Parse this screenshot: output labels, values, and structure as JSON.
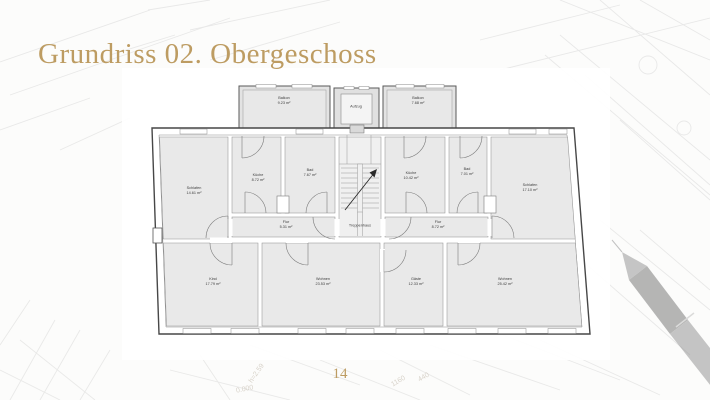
{
  "slide": {
    "title": "Grundriss 02. Obergeschoss",
    "page_number": "14"
  },
  "floorplan": {
    "rooms": [
      {
        "label": "Balkon",
        "area": "9.23 m²"
      },
      {
        "label": "Aufzug",
        "area": ""
      },
      {
        "label": "Balkon",
        "area": "7.68 m²"
      },
      {
        "label": "Schlafen",
        "area": "14.61 m²"
      },
      {
        "label": "Küche",
        "area": "8.72 m²"
      },
      {
        "label": "Bad",
        "area": "7.67 m²"
      },
      {
        "label": "Küche",
        "area": "10.42 m²"
      },
      {
        "label": "Bad",
        "area": "7.01 m²"
      },
      {
        "label": "Schlafen",
        "area": "17.10 m²"
      },
      {
        "label": "Flur",
        "area": "5.31 m²"
      },
      {
        "label": "Treppenhaus",
        "area": ""
      },
      {
        "label": "Flur",
        "area": "8.72 m²"
      },
      {
        "label": "Kind",
        "area": "17.79 m²"
      },
      {
        "label": "Wohnen",
        "area": "23.53 m²"
      },
      {
        "label": "Gäste",
        "area": "12.33 m²"
      },
      {
        "label": "Wohnen",
        "area": "25.42 m²"
      }
    ]
  },
  "watermark": {
    "texts": [
      "h=2.59",
      "0.000",
      "1160",
      "440"
    ]
  },
  "colors": {
    "accent_gold": "#bd9c62",
    "room_fill": "#e9e9e9",
    "wall_line": "#474747"
  }
}
